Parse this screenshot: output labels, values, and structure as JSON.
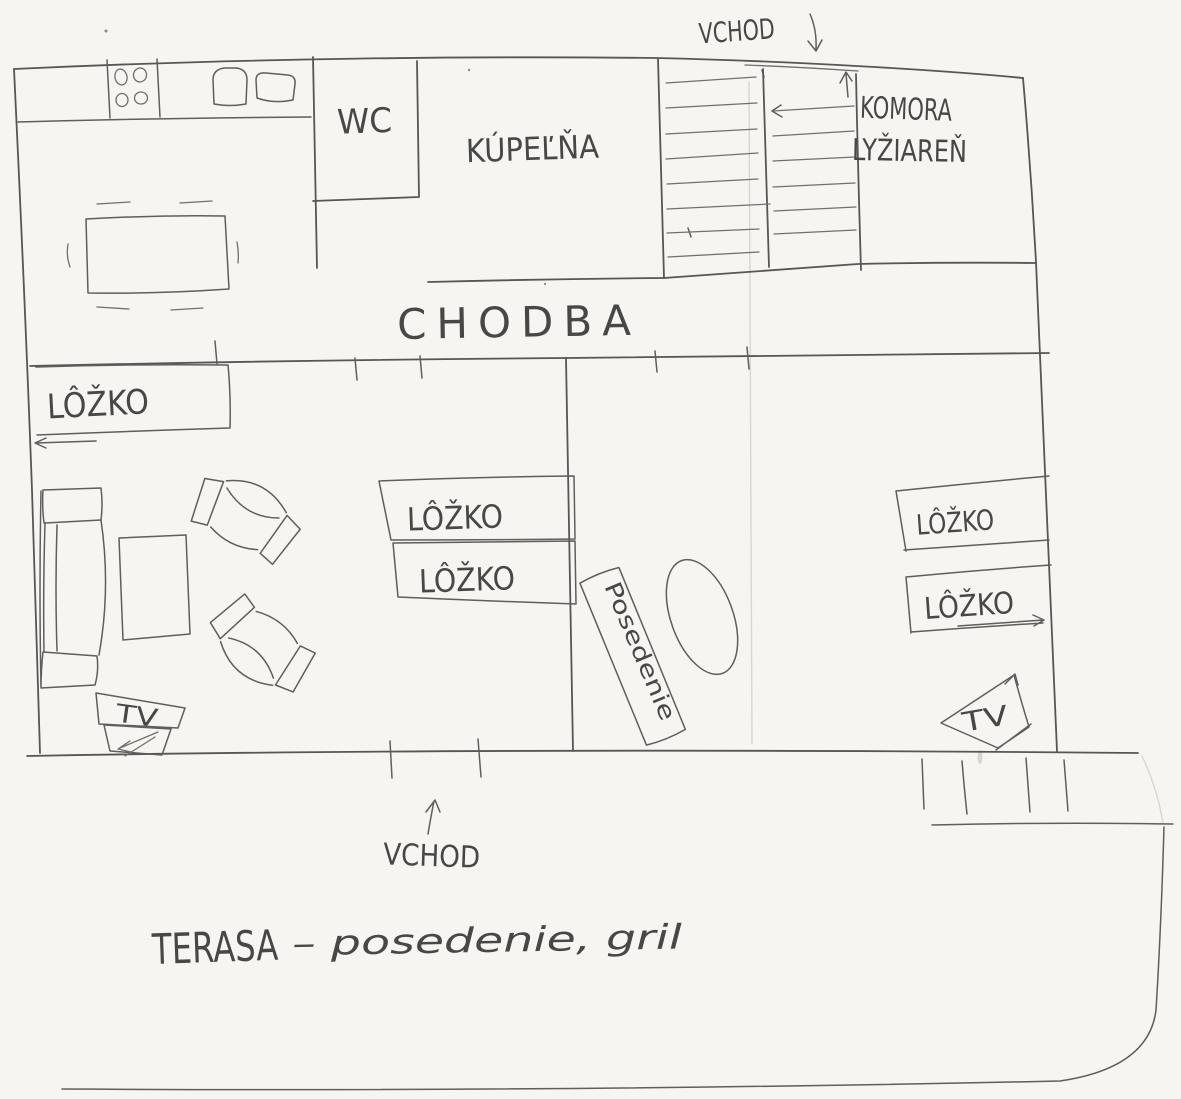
{
  "meta": {
    "kind": "hand-drawn floor plan sketch (pencil on paper)",
    "language": "Slovak"
  },
  "colors": {
    "paper": "#f6f5f1",
    "pencil": "#565656",
    "text": "#474747"
  },
  "entrances": {
    "top": {
      "label": "VCHOD"
    },
    "bottom": {
      "label": "VCHOD"
    }
  },
  "rooms": {
    "hallway": {
      "label": "CHODBA"
    },
    "wc": {
      "label": "WC"
    },
    "bathroom": {
      "label": "KÚPEĽŇA"
    },
    "pantry": {
      "label_line1": "KOMORA",
      "label_line2": "LYŽIAREŇ"
    }
  },
  "beds": {
    "labels": [
      "LÔŽKO",
      "LÔŽKO",
      "LÔŽKO",
      "LÔŽKO",
      "LÔŽKO"
    ]
  },
  "seating": {
    "label": "Posedenie"
  },
  "tv": {
    "left": "TV",
    "right": "TV"
  },
  "terrace": {
    "title": "TERASA",
    "detail": "– posedenie, gril"
  }
}
